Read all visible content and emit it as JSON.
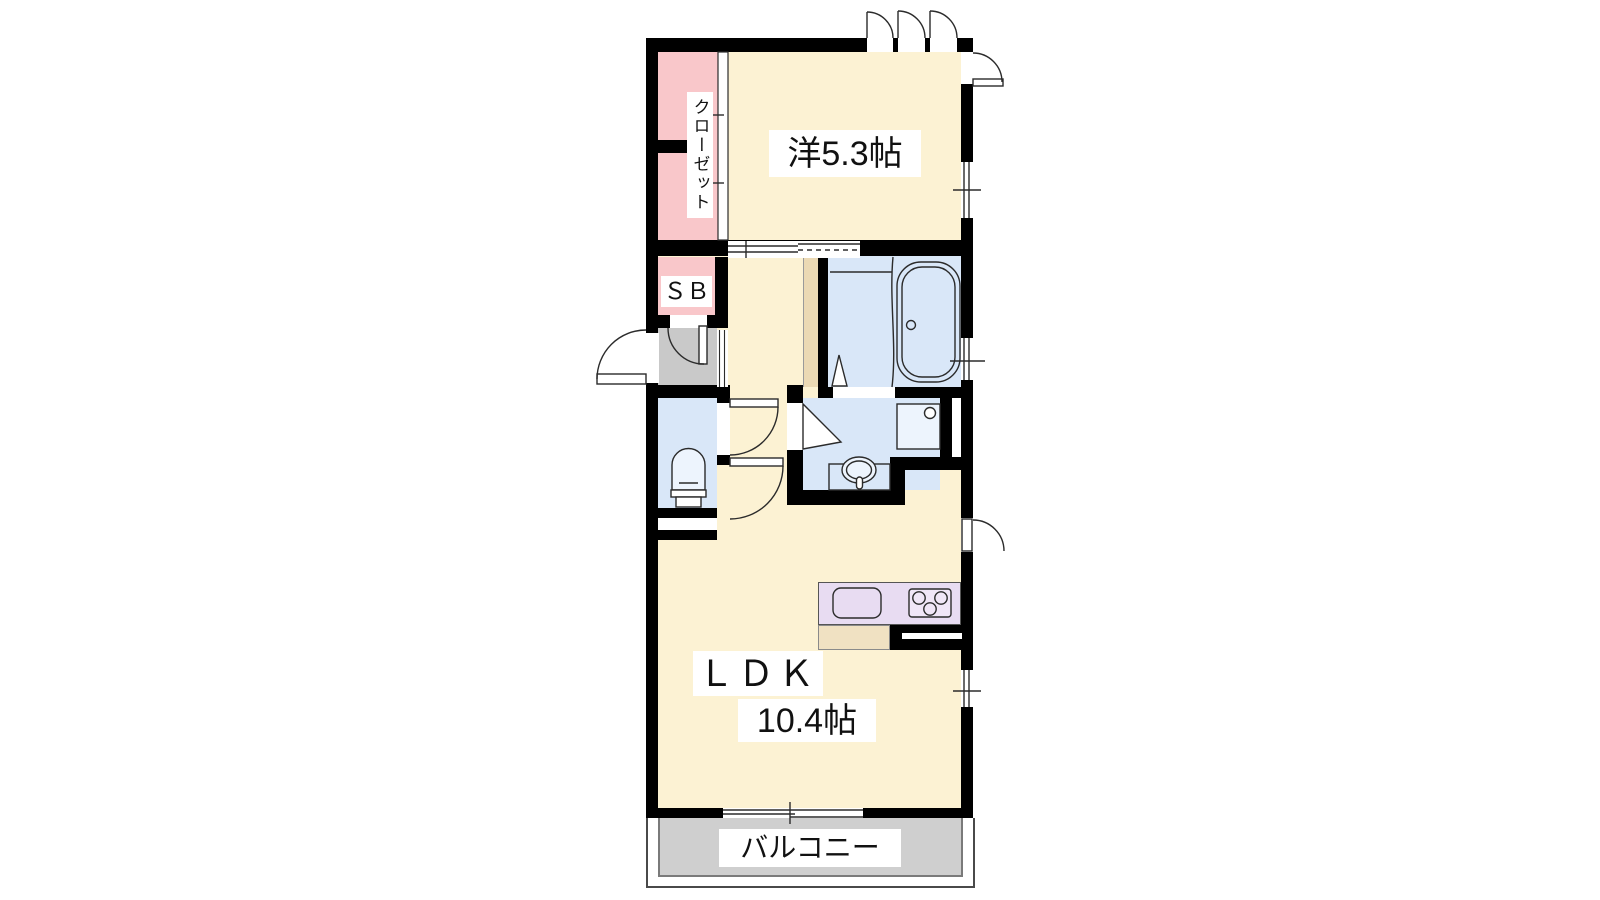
{
  "floorplan": {
    "kind": "japanese-apartment-floor-plan",
    "labels": {
      "closet": "クローゼット",
      "shoe_box": "ＳＢ",
      "western_room": "洋5.3帖",
      "ldk": "ＬＤＫ",
      "ldk_area": "10.4帖",
      "balcony": "バルコニー"
    },
    "rooms": [
      {
        "label": "洋5.3帖",
        "area_tatami": 5.3
      },
      {
        "label": "ＬＤＫ 10.4帖",
        "area_tatami": 10.4
      },
      {
        "label": "クローゼット"
      },
      {
        "label": "ＳＢ"
      },
      {
        "label": "バルコニー"
      }
    ],
    "palette": {
      "wall": "#000000",
      "floor-cream": "#FCF2D3",
      "closet-pink": "#F9C7CA",
      "wet-blue": "#D9E7F8",
      "fixture-blue": "#EDF4FD",
      "genkan-gray": "#C9C9C9",
      "balcony-gray": "#CFCFCF",
      "counter-purple": "#E8DCF2",
      "stove-purple": "#F0E6F7",
      "hall-tan": "#EBD9B4",
      "kitchen-tan": "#F0E1C2",
      "line": "#2B2B2B"
    }
  }
}
